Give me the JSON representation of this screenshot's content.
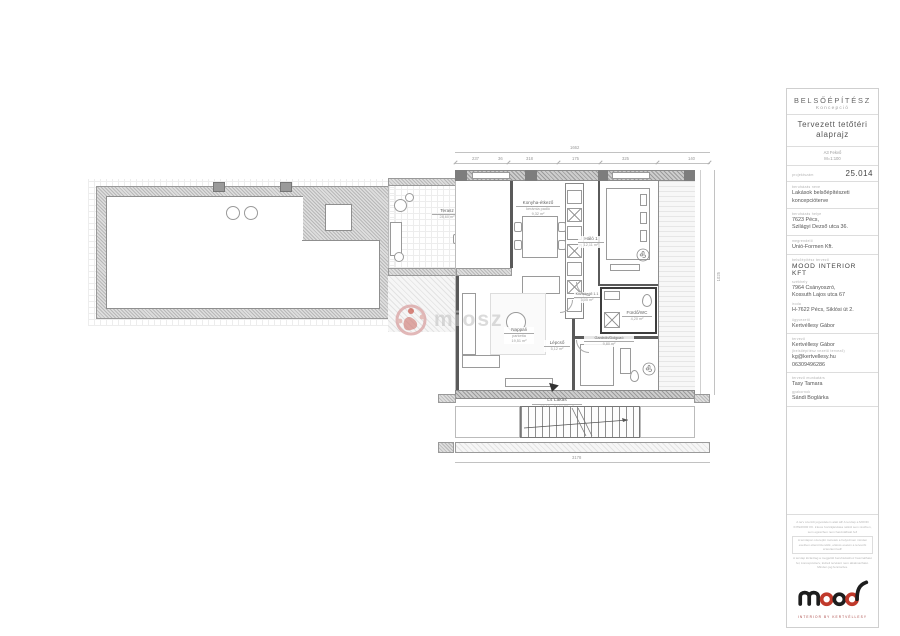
{
  "title_block": {
    "discipline": "BELSŐÉPÍTÉSZ",
    "discipline_sub": "Koncepció",
    "drawing_title": "Tervezett tetőtéri alaprajz",
    "sheet_format": "A3 Fekvő",
    "scale": "M=1:100",
    "drawing_number_label": "projektszám",
    "drawing_number": "25.014",
    "project_name_label": "beruházás neve",
    "project_name": "Lakások belsőépítészeti koncepcióterve",
    "project_address_label": "beruházás helye",
    "project_address_line1": "7623 Pécs,",
    "project_address_line2": "Szilágyi Dezső utca 36.",
    "client_label": "megrendelő",
    "client": "Unió-Formen Kft.",
    "designer_company_label": "belsőépítész tervező",
    "designer_company": "MOOD INTERIOR KFT",
    "hq_label": "székhely",
    "hq_line1": "7964 Csányoszró,",
    "hq_line2": "Kossuth Lajos utca 67",
    "office_label": "iroda",
    "office": "H-7622 Pécs, Siklósi út 2.",
    "manager_label": "ügyvezető",
    "manager": "Kertvéllesy Gábor",
    "designer_label": "tervező",
    "designer": "Kertvéllesy Gábor",
    "designer_note": "(belsőépítész vezető tervező)",
    "designer_email": "kg@kertvellesy.hu",
    "designer_phone": "06309496286",
    "collaborator_label": "tervező munkatárs",
    "collaborator": "Tasy Tamara",
    "intern_label": "gyakornok",
    "intern": "Sándi Boglárka",
    "fine_print": [
      "A terv szerzői jogvédelem alatt áll! A tervlap a MOOD INTERIOR Kft. írásos hozzájárulása nélkül sem részben, sem egészben nem használható fel!",
      "A tervlapon szereplő méretek a helyszínen minden esetben ellenőrizendők, eltérés esetén a tervezőt értesíteni kell!",
      "A tervlap kizárólag a megjelölt beruházáshoz használható fel, koncepcióterv, kiviteli tervként nem alkalmazható. Minden jog fenntartva."
    ],
    "logo_text": "mood",
    "logo_tagline": "INTERIOR BY KERTVÉLLESY"
  },
  "plan": {
    "watermark": "miosz",
    "rooms": {
      "terasz": {
        "name": "Terasz",
        "area": "28,60 m²"
      },
      "konyha": {
        "name": "Konyha-étkező",
        "floor": "kerámia padló",
        "area": "9,32 m²"
      },
      "halo1": {
        "name": "Háló 1",
        "area": "12,11 m²"
      },
      "kozlekedo": {
        "name": "Közlekedő 1.1",
        "area": "3,05 m²"
      },
      "furdo": {
        "name": "Fürdő/WC",
        "area": "4,20 m²"
      },
      "nappali": {
        "name": "Nappali",
        "floor": "parketta",
        "area": "19,51 m²"
      },
      "lepcso": {
        "name": "Lépcső",
        "area": "5,12 m²"
      },
      "gardrob": {
        "name": "Gardrób/Dolgozó",
        "area": "9,80 m²"
      }
    },
    "unit": {
      "name": "L4 Lakás",
      "line1": "92,19 m² / 84,06 m²",
      "line2": "+11,7 m² terasz"
    },
    "dimensions": {
      "top_total": "1662",
      "top_segments": [
        "237",
        "36",
        "318",
        "175",
        "325",
        "140"
      ],
      "bottom_total": "3178",
      "right_total": "1025"
    }
  }
}
